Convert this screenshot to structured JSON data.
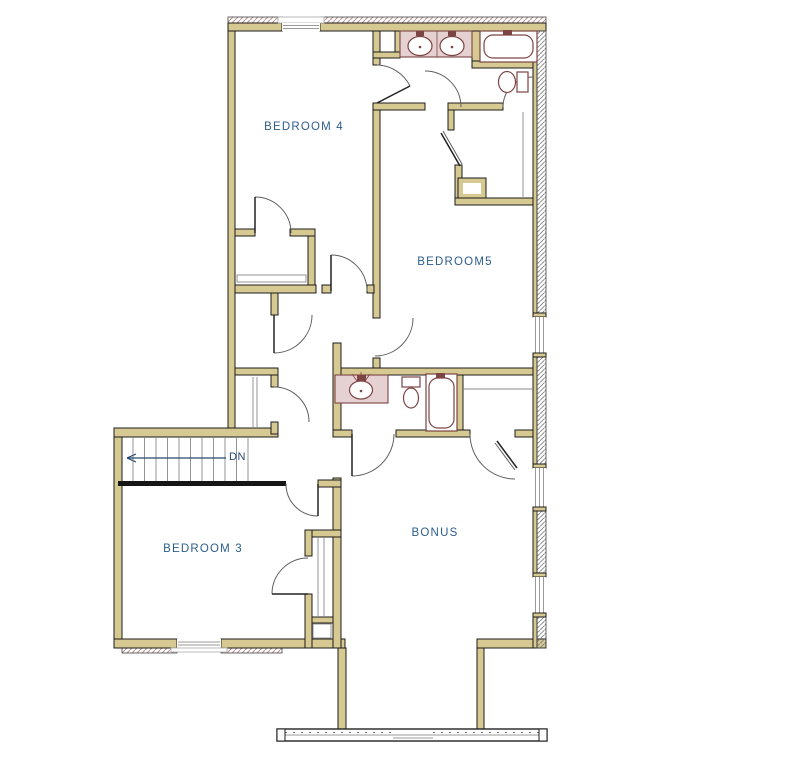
{
  "plan": {
    "type": "floor-plan",
    "rooms": {
      "bedroom4": {
        "label": "BEDROOM 4"
      },
      "bedroom5": {
        "label": "BEDROOM5"
      },
      "bedroom3": {
        "label": "BEDROOM 3"
      },
      "bonus": {
        "label": "BONUS"
      }
    },
    "stairs": {
      "direction_label": "DN"
    }
  },
  "colors": {
    "background": "#ffffff",
    "wall_fill": "#d6c992",
    "wall_outline": "#1c1c1c",
    "room_label": "#2e5d8c",
    "fixture_outline": "#7d4444",
    "counter_fill": "#e5d1d1",
    "stair_arrow": "#27496d",
    "hatch": "#b98f8f",
    "window_line": "#9a9a9a"
  }
}
